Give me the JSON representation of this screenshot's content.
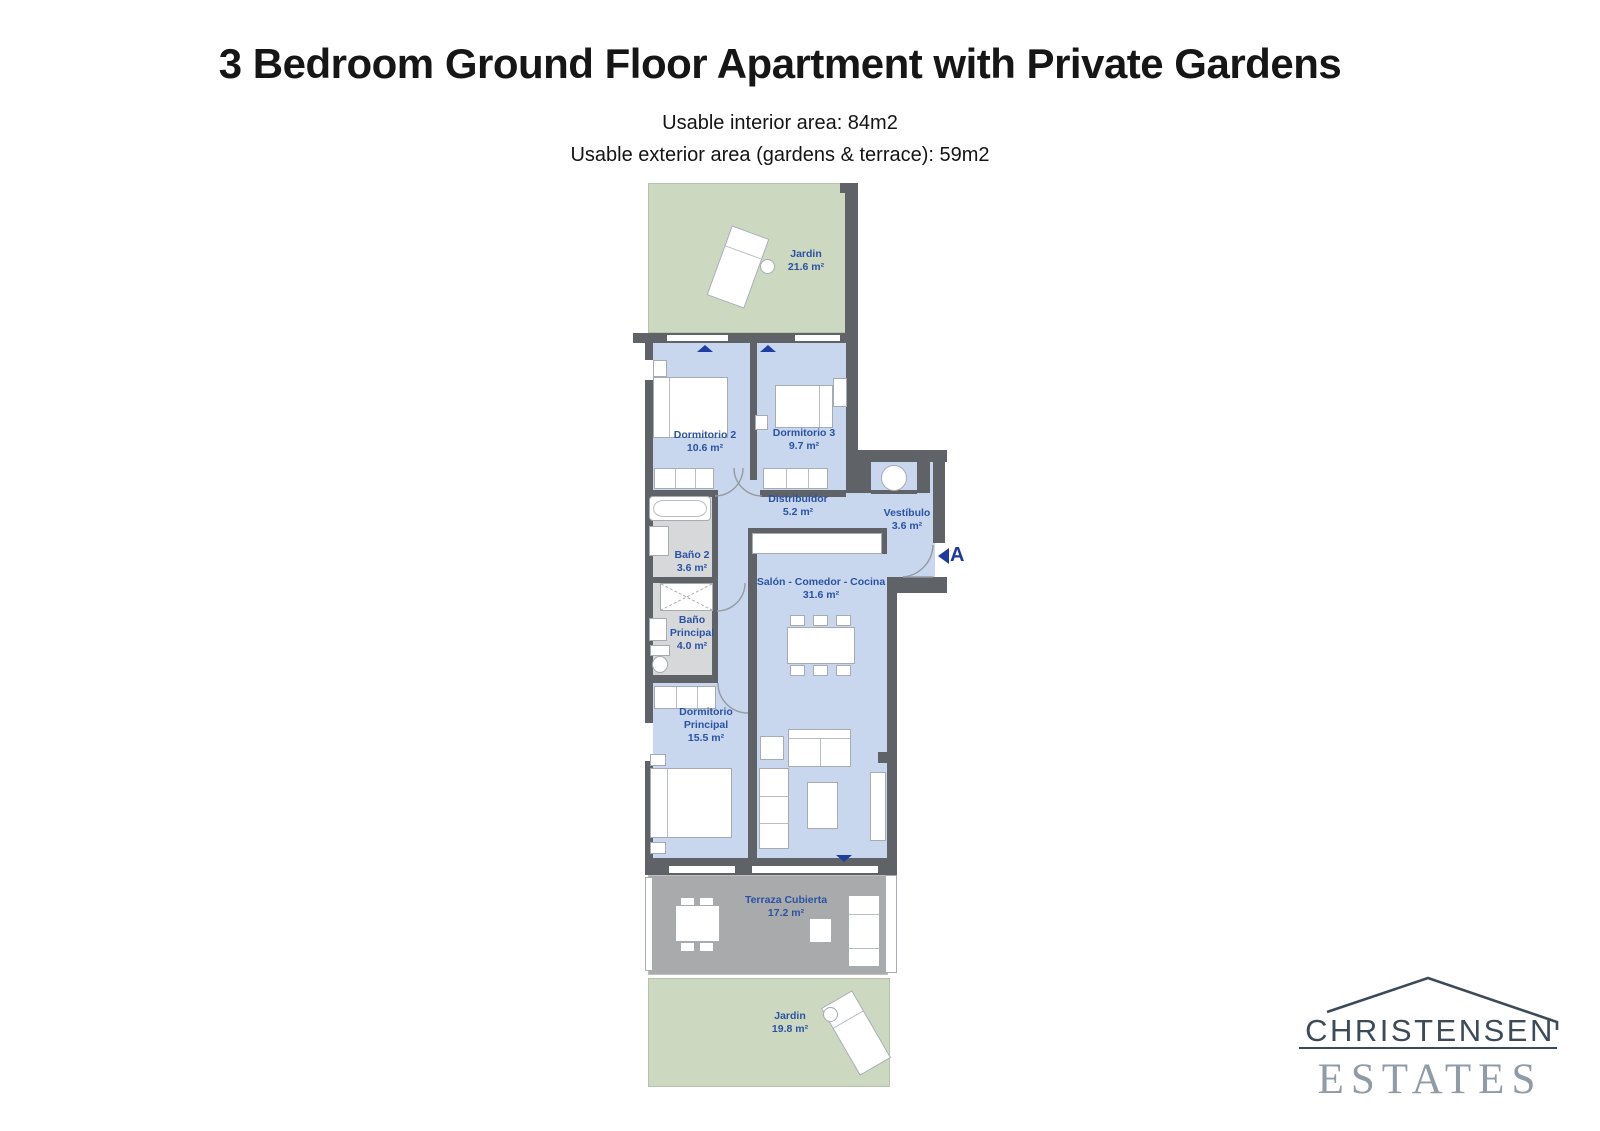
{
  "header": {
    "title": "3 Bedroom Ground Floor Apartment with Private Gardens",
    "subtitle1": "Usable interior area: 84m2",
    "subtitle2": "Usable exterior area (gardens & terrace): 59m2"
  },
  "rooms": {
    "garden_top": {
      "name": "Jardin",
      "area": "21.6 m²"
    },
    "dormitorio2": {
      "name": "Dormitorio 2",
      "area": "10.6 m²"
    },
    "dormitorio3": {
      "name": "Dormitorio 3",
      "area": "9.7 m²"
    },
    "distribuidor": {
      "name": "Distribuidor",
      "area": "5.2 m²"
    },
    "vestibulo": {
      "name": "Vestíbulo",
      "area": "3.6 m²"
    },
    "bano2": {
      "name": "Baño 2",
      "area": "3.6 m²"
    },
    "salon": {
      "name": "Salón - Comedor - Cocina",
      "area": "31.6 m²"
    },
    "bano_principal": {
      "name": "Baño",
      "name2": "Principal",
      "area": "4.0 m²"
    },
    "dormitorio_principal": {
      "name": "Dormitorio",
      "name2": "Principal",
      "area": "15.5 m²"
    },
    "terraza": {
      "name": "Terraza Cubierta",
      "area": "17.2 m²"
    },
    "garden_bottom": {
      "name": "Jardin",
      "area": "19.8 m²"
    }
  },
  "entrance": {
    "label": "A"
  },
  "logo": {
    "line1": "CHRISTENSEN",
    "line2": "ESTATES"
  },
  "colors": {
    "wall": "#5f6267",
    "floor_blue": "#c8d7ee",
    "garden_green": "#cdd8c1",
    "terrace_gray": "#a8aaac",
    "bath_gray": "#d7d8da",
    "label_blue": "#2b52a3",
    "marker_navy": "#1e3a9e",
    "logo_dark": "#3d4b59",
    "logo_light": "#8f9ba6"
  }
}
